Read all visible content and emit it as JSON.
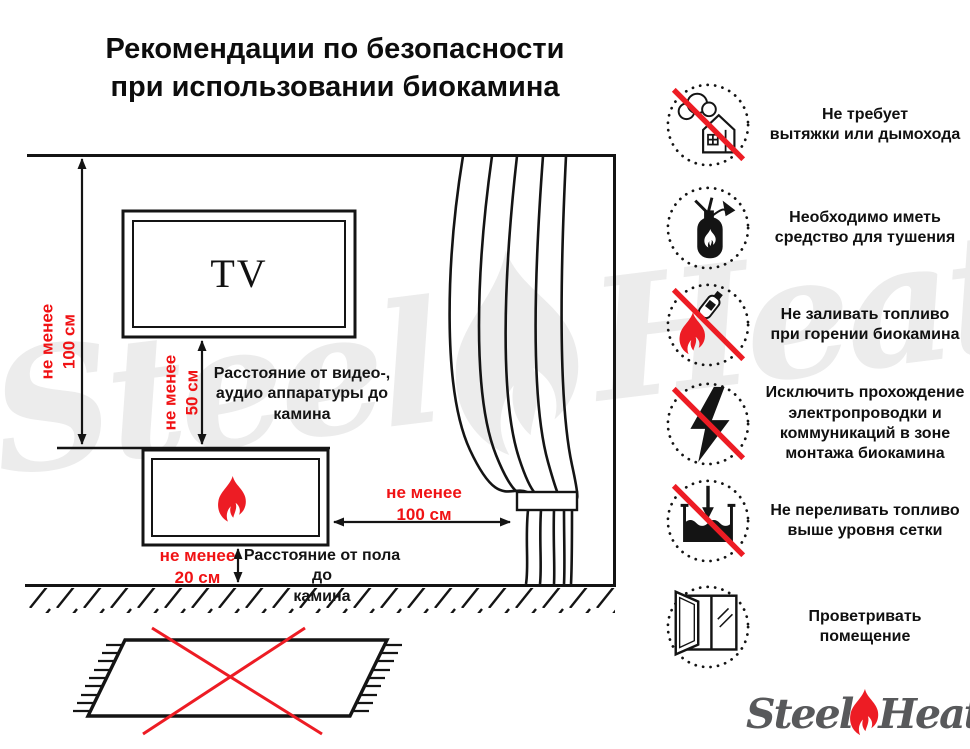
{
  "title": {
    "line1": "Рекомендации по безопасности",
    "line2": "при использовании биокамина"
  },
  "watermark": {
    "steel": "Steel",
    "heat": "Heat"
  },
  "diagram": {
    "tv_label": "TV",
    "dim_wall": "не менее\n100 см",
    "dim_tv": "не менее\n50 см",
    "caption_tv": "Расстояние от видео-,\nаудио аппаратуры до\nкамина",
    "dim_curtain": "не менее\n100 см",
    "dim_floor": "не менее\n20 см",
    "caption_floor": "Расстояние от пола до\nкамина"
  },
  "icons": [
    {
      "name": "no-chimney-required",
      "text": "Не требует\nвытяжки или дымохода"
    },
    {
      "name": "extinguishing-means",
      "text": "Необходимо иметь\nсредство для тушения"
    },
    {
      "name": "no-refuel-while-burning",
      "text": "Не заливать топливо\nпри горении биокамина"
    },
    {
      "name": "no-wiring-in-zone",
      "text": "Исключить прохождение\nэлектропроводки и\nкоммуникаций в зоне\nмонтажа биокамина"
    },
    {
      "name": "no-overfill",
      "text": "Не переливать топливо\nвыше уровня сетки"
    },
    {
      "name": "ventilate-room",
      "text": "Проветривать\nпомещение"
    }
  ],
  "logo": {
    "steel": "Steel",
    "heat": "Heat"
  },
  "colors": {
    "red_accent": "#ed1c24",
    "red_text": "#f01214",
    "ink": "#141414",
    "watermark_gray": "#ececec",
    "logo_gray": "#58595b"
  }
}
